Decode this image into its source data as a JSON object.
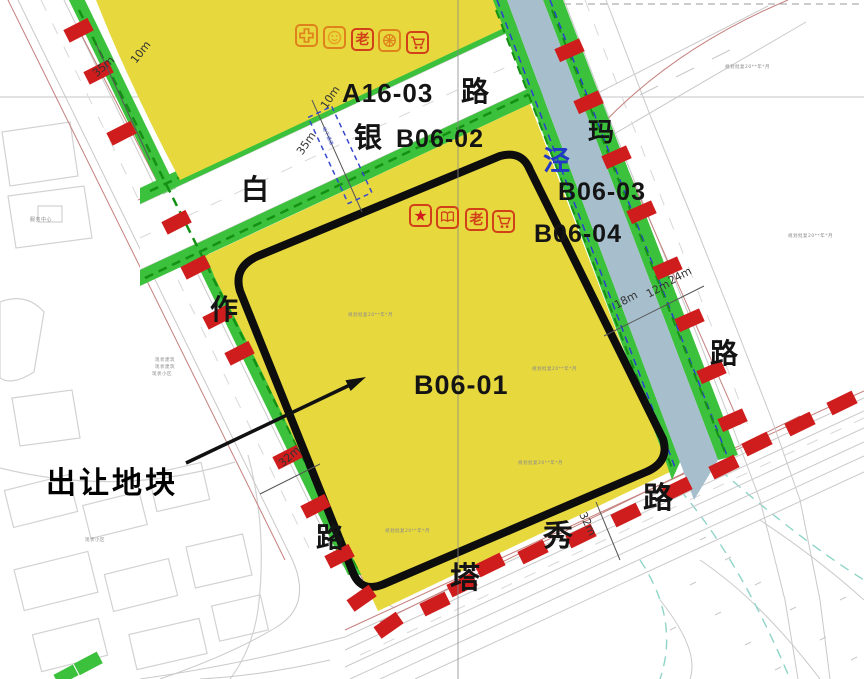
{
  "colors": {
    "yellow": "#e7d83e",
    "green": "#3cc13c",
    "greendash": "#149014",
    "river": "#a7bfcd",
    "red": "#cf1d1d",
    "boundary": "#0d0d0d",
    "roadline": "#c9c9c9",
    "redline": "#c4807d",
    "bluetext": "#2438c8",
    "ann": "#8a8a8a",
    "iconorange": "#e0821c",
    "iconred": "#d2401a",
    "teal": "#8fd4c8",
    "bldg": "#d2d2d2"
  },
  "plot": {
    "callout_label": "出让地块"
  },
  "parcel_labels": {
    "a16_03": "A16-03",
    "b06_02": "B06-02",
    "b06_01": "B06-01",
    "b06_03": "B06-03",
    "b06_04": "B06-04"
  },
  "road_names": {
    "top": [
      "白",
      "银",
      "路"
    ],
    "left": [
      "作",
      "路"
    ],
    "right": [
      "玛",
      "路"
    ],
    "bottom": [
      "塔",
      "秀",
      "路"
    ]
  },
  "river": {
    "name_char": "泾"
  },
  "dimensions": [
    {
      "text": "35m"
    },
    {
      "text": "10m"
    },
    {
      "text": "10m"
    },
    {
      "text": "35m"
    },
    {
      "text": "18m"
    },
    {
      "text": "12m"
    },
    {
      "text": "24m"
    },
    {
      "text": "32m"
    },
    {
      "text": "32m"
    }
  ],
  "facility_icons": {
    "row_top": [
      "medical-cross",
      "smiley-face",
      "elder-care",
      "wheel",
      "shopping-cart"
    ],
    "row_parcel": [
      "star",
      "book",
      "elder-care",
      "shopping-cart"
    ],
    "elder_glyph": "老",
    "star_glyph": "★"
  },
  "underpass_label": "地下通道",
  "annotations": {
    "a0": "规划批复20**年*月",
    "a1": "规划批复20**年*月",
    "a2": "规划批复20**年*月",
    "a3": "规划批复20**年*月",
    "a4": "规划批复20**年*月",
    "a5": "规划批复20**年*月",
    "bldg": "服务中心",
    "left1": "现状建筑",
    "left2": "现状建筑",
    "left3": "现状小区",
    "bl": "现状小区"
  }
}
